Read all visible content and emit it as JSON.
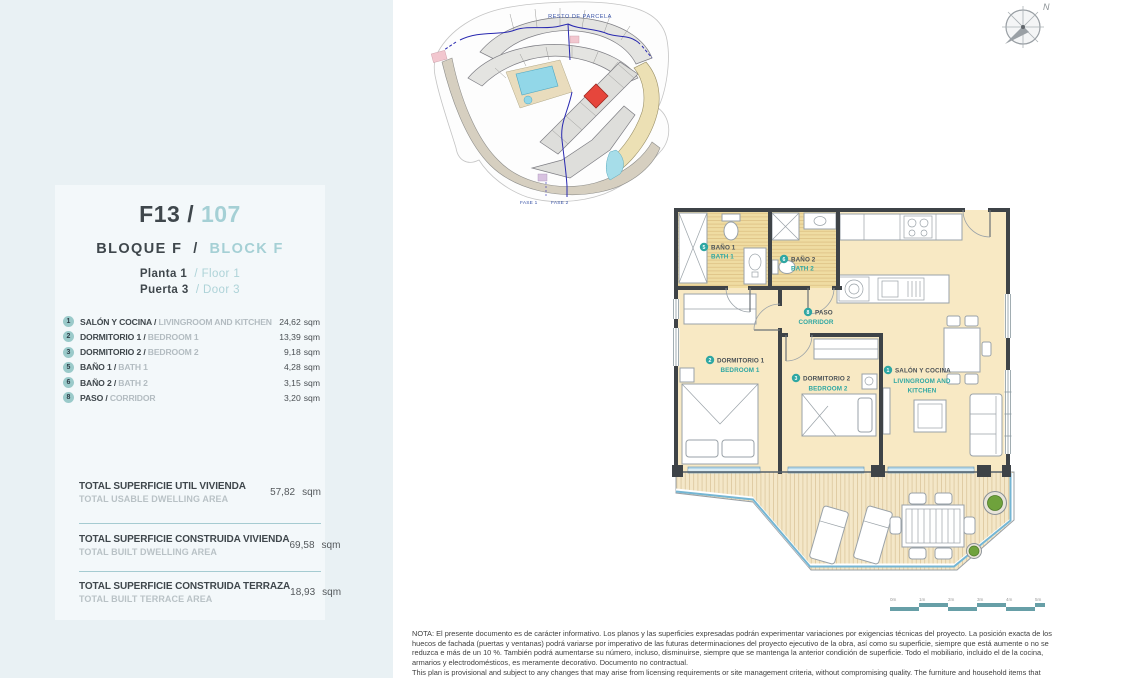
{
  "sep": "/",
  "panel": {
    "title": {
      "code": "F13",
      "sep": "/",
      "number": "107"
    },
    "block": {
      "es": "BLOQUE F",
      "sep": "/",
      "en": "BLOCK F"
    },
    "floor": {
      "es": "Planta 1",
      "sep": "/",
      "en": "Floor 1"
    },
    "door": {
      "es": "Puerta 3",
      "sep": "/",
      "en": "Door 3"
    },
    "rooms": [
      {
        "num": "1",
        "es": "SALÓN Y COCINA",
        "en": "LIVINGROOM AND KITCHEN",
        "area": "24,62",
        "unit": "sqm"
      },
      {
        "num": "2",
        "es": "DORMITORIO 1",
        "en": "BEDROOM 1",
        "area": "13,39",
        "unit": "sqm"
      },
      {
        "num": "3",
        "es": "DORMITORIO 2",
        "en": "BEDROOM 2",
        "area": "9,18",
        "unit": "sqm"
      },
      {
        "num": "5",
        "es": "BAÑO 1",
        "en": "BATH 1",
        "area": "4,28",
        "unit": "sqm"
      },
      {
        "num": "6",
        "es": "BAÑO 2",
        "en": "BATH 2",
        "area": "3,15",
        "unit": "sqm"
      },
      {
        "num": "8",
        "es": "PASO",
        "en": "CORRIDOR",
        "area": "3,20",
        "unit": "sqm"
      }
    ],
    "totals": [
      {
        "es": "TOTAL SUPERFICIE UTIL VIVIENDA",
        "en": "TOTAL USABLE DWELLING AREA",
        "value": "57,82",
        "unit": "sqm"
      },
      {
        "es": "TOTAL SUPERFICIE CONSTRUIDA VIVIENDA",
        "en": "TOTAL BUILT DWELLING AREA",
        "value": "69,58",
        "unit": "sqm"
      },
      {
        "es": "TOTAL SUPERFICIE CONSTRUIDA TERRAZA",
        "en": "TOTAL BUILT TERRACE AREA",
        "value": "18,93",
        "unit": "sqm"
      }
    ]
  },
  "site_plan": {
    "area_label": "RESTO DE PARCELA",
    "phase1_label": "FASE 1",
    "phase2_label": "FASE 2"
  },
  "floor_plan": {
    "labels": {
      "bath1": {
        "num": "5",
        "es": "BAÑO 1",
        "en": "BATH 1"
      },
      "bath2": {
        "num": "6",
        "es": "BAÑO 2",
        "en": "BATH 2"
      },
      "corridor": {
        "num": "8",
        "es": "PASO",
        "en": "CORRIDOR"
      },
      "bedroom1": {
        "num": "2",
        "es": "DORMITORIO 1",
        "en": "BEDROOM 1"
      },
      "bedroom2": {
        "num": "3",
        "es": "DORMITORIO 2",
        "en": "BEDROOM 2"
      },
      "living": {
        "num": "1",
        "es": "SALÓN Y COCINA",
        "en_lines": [
          "LIVINGROOM AND",
          "KITCHEN"
        ]
      }
    }
  },
  "compass": {
    "label": "N"
  },
  "scale_bar": {
    "labels": [
      "0m",
      "1m",
      "2m",
      "3m",
      "4m",
      "5m"
    ]
  },
  "note": {
    "lines": [
      "NOTA: El presente documento es de carácter informativo. Los planos y las superficies expresadas podrán experimentar variaciones por exigencias técnicas del proyecto. La posición exacta de los",
      "huecos de fachada (puertas y ventanas) podrá variarse por imperativo de las futuras determinaciones del proyecto ejecutivo de la obra, así como su superficie, siempre que está aumente o no se",
      "reduzca e más de un 10 %. También podrá aumentarse su número, incluso, disminuirse, siempre que se mantenga la anterior condición de superficie. Todo el mobiliario, incluido el de la cocina,",
      "armarios y electrodomésticos, es meramente decorativo. Documento no contractual.",
      "This plan is provisional and subject to any changes that may arise from licensing requirements or site management criteria, without compromising quality. The furniture and household items that"
    ]
  },
  "colors": {
    "accent_teal": "#2fa7a3",
    "light_teal": "#a5d0d5",
    "highlight_red": "#e6463c",
    "room_fill": "#f8e9c4",
    "bath_fill": "#efdca2",
    "glass_blue": "#b7d9ea",
    "deck_fill": "#f4e7c8",
    "panel_band": "#e9f1f4"
  }
}
